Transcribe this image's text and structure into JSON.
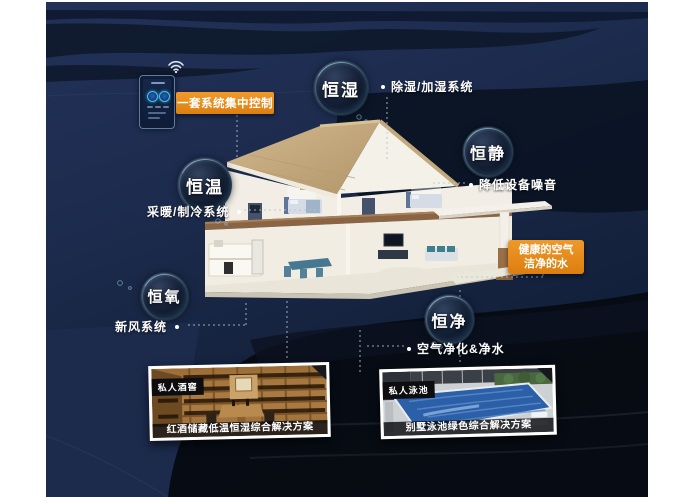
{
  "colors": {
    "accent_orange": "#e5891e",
    "canvas_navy": "#1d2b4b",
    "canvas_dark": "#070b13",
    "bubble_rim_cyan": "#8fd2ea"
  },
  "control_panel": {
    "label": "一套系统集中控制",
    "wifi_icon": "wifi-icon",
    "phone_icon": "smart-home-controller"
  },
  "features": [
    {
      "name": "恒湿",
      "desc": "除湿/加湿系统"
    },
    {
      "name": "恒静",
      "desc": "降低设备噪音"
    },
    {
      "name": "恒温",
      "desc": "采暖/制冷系统"
    },
    {
      "name": "恒氧",
      "desc": "新风系统"
    },
    {
      "name": "恒净",
      "desc": "空气净化&净水"
    }
  ],
  "highlight": {
    "line1": "健康的空气",
    "line2": "洁净的水"
  },
  "photos": [
    {
      "tag": "私人酒窖",
      "caption": "红酒储藏低温恒湿综合解决方案"
    },
    {
      "tag": "私人泳池",
      "caption": "别墅泳池绿色综合解决方案"
    }
  ]
}
